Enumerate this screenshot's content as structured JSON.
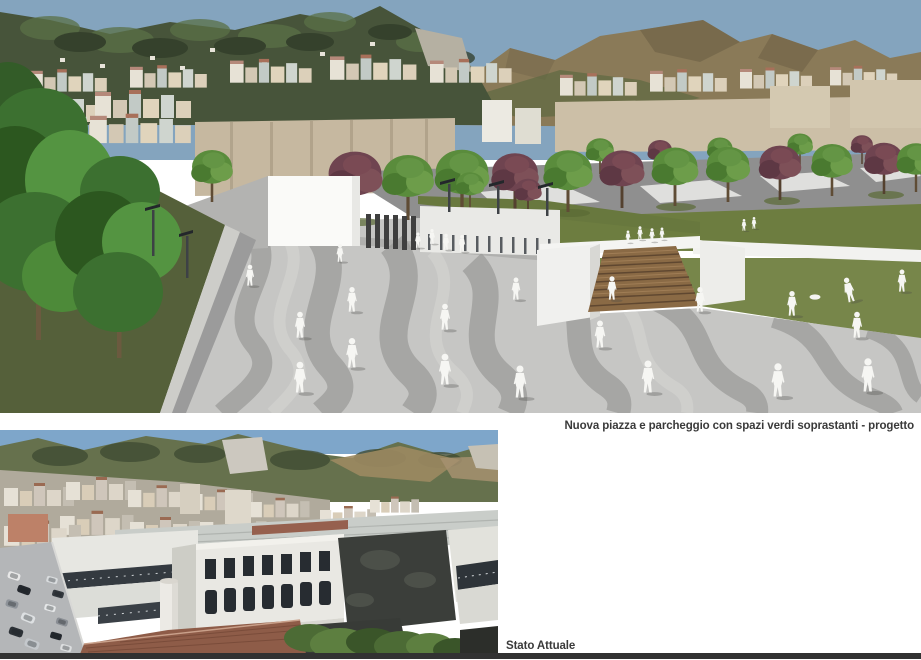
{
  "page": {
    "background": "#ffffff",
    "caption_color": "#3a3a3a",
    "divider_color": "#323232"
  },
  "figures": {
    "progetto": {
      "caption": "Nuova piazza e parcheggio con spazi verdi soprastanti - progetto",
      "colors": {
        "sky": "#84a4be",
        "hill_green": "#47543a",
        "hill_brown": "#8a7a58",
        "quarry": "#b5b0a2",
        "city_beige": "#c6b8a0",
        "lawn": "#6d7d40",
        "lawn_lower": "#77864a",
        "plaza_light": "#c6c6c4",
        "plaza_dark": "#a6a6a4",
        "wall_white": "#fafaf8",
        "stairs_wood": "#8a6a45",
        "tree_green": "#5a8c3c",
        "tree_purple": "#6f4450",
        "verge_green": "#55603a",
        "figure_white": "#f6f6f3"
      }
    },
    "stato_attuale": {
      "caption": "Stato Attuale",
      "colors": {
        "sky": "#7ea6ca",
        "hills": "#66714d",
        "quarry": "#ccc8bf",
        "city": "#b0aa9c",
        "building_white": "#e9e8e3",
        "window_dark": "#272c31",
        "roof_dark": "#3b3e3a",
        "street": "#b4b6b8",
        "brick": "#8e5c48",
        "vegetation": "#4c6b35"
      }
    }
  }
}
